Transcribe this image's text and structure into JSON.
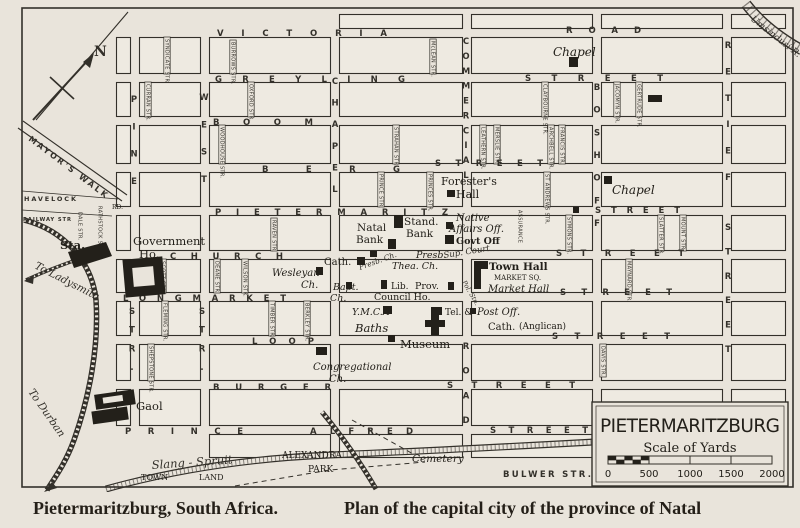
{
  "captions": {
    "left": "Pietermaritzburg, South Africa.",
    "right": "Plan of the capital city of the province of Natal"
  },
  "map": {
    "title_box": {
      "title": "PIETERMARITZBURG",
      "scale_caption": "Scale of Yards",
      "scale_ticks": [
        "0",
        "500",
        "1000",
        "1500",
        "2000"
      ]
    },
    "compass": {
      "label": "N"
    },
    "streets_h": [
      {
        "t": "VICTORIA",
        "x": 217,
        "y": 36,
        "w": 170
      },
      {
        "t": "ROAD",
        "x": 566,
        "y": 33,
        "w": 75
      },
      {
        "t": "GREYLING",
        "x": 215,
        "y": 82,
        "w": 190
      },
      {
        "t": "STREET",
        "x": 525,
        "y": 81,
        "w": 138
      },
      {
        "t": "BOOM",
        "x": 213,
        "y": 125,
        "w": 100
      },
      {
        "t": "BERG",
        "x": 262,
        "y": 172,
        "w": 138
      },
      {
        "t": "STREET",
        "x": 435,
        "y": 166,
        "w": 108
      },
      {
        "t": "PIETERMARITZ",
        "x": 215,
        "y": 215,
        "w": 233
      },
      {
        "t": "STREET",
        "x": 595,
        "y": 213,
        "w": 85
      },
      {
        "t": "CHURCH",
        "x": 170,
        "y": 259,
        "w": 113
      },
      {
        "t": "STREET",
        "x": 556,
        "y": 256,
        "w": 128
      },
      {
        "t": "LONGMARKET",
        "x": 123,
        "y": 301,
        "w": 163
      },
      {
        "t": "STREET",
        "x": 560,
        "y": 295,
        "w": 112
      },
      {
        "t": "LOOP",
        "x": 252,
        "y": 344,
        "w": 62
      },
      {
        "t": "STREET",
        "x": 552,
        "y": 339,
        "w": 118
      },
      {
        "t": "BURGER",
        "x": 213,
        "y": 390,
        "w": 118
      },
      {
        "t": "STREET",
        "x": 447,
        "y": 388,
        "w": 128
      },
      {
        "t": "PRINCE",
        "x": 125,
        "y": 434,
        "w": 118
      },
      {
        "t": "ALFRED",
        "x": 310,
        "y": 434,
        "w": 103
      },
      {
        "t": "STREET",
        "x": 490,
        "y": 433,
        "w": 98
      },
      {
        "t": "BULWER STR.",
        "x": 503,
        "y": 477,
        "w": 88
      },
      {
        "t": "HAVELOCK",
        "x": 24,
        "y": 201,
        "w": 52,
        "s": 6.5
      },
      {
        "t": "RAILWAY STR",
        "x": 23,
        "y": 221,
        "w": 48,
        "s": 5.2
      }
    ],
    "streets_v": [
      {
        "t": "PINE",
        "x": 134,
        "y1": 102,
        "y2": 184
      },
      {
        "t": "WEST",
        "x": 204,
        "y1": 100,
        "y2": 182
      },
      {
        "t": "STR.",
        "x": 132,
        "y1": 314,
        "y2": 370
      },
      {
        "t": "STR.",
        "x": 202,
        "y1": 314,
        "y2": 370
      },
      {
        "t": "CHAPEL",
        "x": 335,
        "y1": 84,
        "y2": 192
      },
      {
        "t": "COMMERCIAL",
        "x": 466,
        "y1": 44,
        "y2": 178
      },
      {
        "t": "ROAD",
        "x": 466,
        "y1": 349,
        "y2": 423
      },
      {
        "t": "BOSHOFF",
        "x": 597,
        "y1": 90,
        "y2": 226
      },
      {
        "t": "RETIEF",
        "x": 728,
        "y1": 48,
        "y2": 180
      },
      {
        "t": "STREET",
        "x": 728,
        "y1": 230,
        "y2": 352
      }
    ],
    "lanes": [
      {
        "t": "SYNDICATE STR.",
        "x": 167,
        "y1": 37,
        "y2": 74
      },
      {
        "t": "BURROWS STR.",
        "x": 233,
        "y1": 40,
        "y2": 74
      },
      {
        "t": "McLEAN STR.",
        "x": 433,
        "y1": 39,
        "y2": 74
      },
      {
        "t": "CURRAN STR.",
        "x": 148,
        "y1": 82,
        "y2": 117
      },
      {
        "t": "OXFORD STR.",
        "x": 251,
        "y1": 82,
        "y2": 117
      },
      {
        "t": "JACOMYN STR.",
        "x": 617,
        "y1": 82,
        "y2": 117
      },
      {
        "t": "GERTRUDE STR.",
        "x": 639,
        "y1": 82,
        "y2": 117
      },
      {
        "t": "CLAYBOURNE STR.",
        "x": 545,
        "y1": 82,
        "y2": 117
      },
      {
        "t": "WOODHOUSE STR.",
        "x": 222,
        "y1": 125,
        "y2": 164
      },
      {
        "t": "STRAHAN STR.",
        "x": 396,
        "y1": 125,
        "y2": 164
      },
      {
        "t": "LEATHERN STR.",
        "x": 483,
        "y1": 125,
        "y2": 164
      },
      {
        "t": "MERSLIE STR.",
        "x": 497,
        "y1": 125,
        "y2": 164
      },
      {
        "t": "ARCHBELL STR.",
        "x": 551,
        "y1": 125,
        "y2": 164
      },
      {
        "t": "FRANCIS STR.",
        "x": 562,
        "y1": 125,
        "y2": 164
      },
      {
        "t": "PRINCE STR.",
        "x": 381,
        "y1": 172,
        "y2": 207
      },
      {
        "t": "PRINCES STR.",
        "x": 430,
        "y1": 172,
        "y2": 207
      },
      {
        "t": "ST ANDREWS STR.",
        "x": 547,
        "y1": 172,
        "y2": 207
      },
      {
        "t": "ASSURANCE",
        "x": 520,
        "y1": 208,
        "y2": 251,
        "ns": true
      },
      {
        "t": "SYMONS STR.",
        "x": 569,
        "y1": 215,
        "y2": 251
      },
      {
        "t": "SLATTER STR.",
        "x": 661,
        "y1": 215,
        "y2": 251
      },
      {
        "t": "MOUNT STR.",
        "x": 683,
        "y1": 215,
        "y2": 251
      },
      {
        "t": "RAVEN STR.",
        "x": 274,
        "y1": 218,
        "y2": 251
      },
      {
        "t": "SCOTT STR.",
        "x": 163,
        "y1": 259,
        "y2": 293
      },
      {
        "t": "DEANE STR.",
        "x": 217,
        "y1": 259,
        "y2": 293
      },
      {
        "t": "WILSON STR.",
        "x": 245,
        "y1": 259,
        "y2": 293
      },
      {
        "t": "MAYNARD STR.",
        "x": 629,
        "y1": 259,
        "y2": 293
      },
      {
        "t": "TIMBER STR.",
        "x": 272,
        "y1": 301,
        "y2": 336
      },
      {
        "t": "BERKLEY STR.",
        "x": 307,
        "y1": 301,
        "y2": 336
      },
      {
        "t": "FLEMING STR.",
        "x": 165,
        "y1": 301,
        "y2": 336
      },
      {
        "t": "SHEPSTONE STR.",
        "x": 151,
        "y1": 344,
        "y2": 381
      },
      {
        "t": "DAVIS STR.",
        "x": 603,
        "y1": 344,
        "y2": 377
      },
      {
        "t": "DALE STR.",
        "x": 80,
        "y1": 210,
        "y2": 234,
        "ns": true
      },
      {
        "t": "RATHSTOCK STR.",
        "x": 100,
        "y1": 204,
        "y2": 256,
        "ns": true
      }
    ],
    "diagonals": [
      {
        "t": "MAYOR'S WALK",
        "x": 28,
        "y": 140,
        "r": 37,
        "s": 8,
        "b": true,
        "sp": 2.5
      },
      {
        "t": "To Ladysmith",
        "x": 34,
        "y": 268,
        "r": 27,
        "s": 10.5,
        "i": true
      },
      {
        "t": "To Durban",
        "x": 28,
        "y": 392,
        "r": 55,
        "s": 10.5,
        "i": true
      },
      {
        "t": "Umsindusi R.",
        "x": 750,
        "y": 20,
        "r": 38,
        "s": 9,
        "i": true
      },
      {
        "t": "Slang - Spruit",
        "x": 152,
        "y": 469,
        "r": -4,
        "s": 11.5,
        "i": true
      },
      {
        "t": "Presb. Ch.",
        "x": 360,
        "y": 270,
        "r": -20,
        "s": 7.5,
        "i": true
      },
      {
        "t": "Pol. Stn.",
        "x": 462,
        "y": 282,
        "r": 60,
        "s": 6.5,
        "i": true
      },
      {
        "t": "Sup. Court",
        "x": 444,
        "y": 258,
        "r": -9,
        "s": 8.5,
        "i": true
      }
    ],
    "pois": [
      {
        "t": "Chapel",
        "x": 553,
        "y": 56,
        "st": "i",
        "s": 12
      },
      {
        "t": "Chapel",
        "x": 612,
        "y": 194,
        "st": "i",
        "s": 12
      },
      {
        "t": "Forester's",
        "x": 441,
        "y": 185,
        "st": "p",
        "s": 11
      },
      {
        "t": "Hall",
        "x": 456,
        "y": 198,
        "st": "p",
        "s": 11
      },
      {
        "t": "Native",
        "x": 456,
        "y": 221,
        "st": "i",
        "s": 10
      },
      {
        "t": "Affairs Off.",
        "x": 449,
        "y": 232,
        "st": "i",
        "s": 10
      },
      {
        "t": "Govt Off",
        "x": 456,
        "y": 244,
        "st": "b",
        "s": 9.5
      },
      {
        "t": "Town Hall",
        "x": 489,
        "y": 270,
        "st": "b",
        "s": 10.5
      },
      {
        "t": "MARKET SQ.",
        "x": 494,
        "y": 280,
        "st": "p",
        "s": 7
      },
      {
        "t": "Market Hall",
        "x": 488,
        "y": 292,
        "st": "i",
        "s": 10
      },
      {
        "t": "Natal",
        "x": 357,
        "y": 231,
        "st": "p",
        "s": 10.5
      },
      {
        "t": "Bank",
        "x": 356,
        "y": 243,
        "st": "p",
        "s": 10.5
      },
      {
        "t": "Stand.",
        "x": 404,
        "y": 225,
        "st": "p",
        "s": 10.5
      },
      {
        "t": "Bank",
        "x": 406,
        "y": 237,
        "st": "p",
        "s": 10.5
      },
      {
        "t": "Cath.",
        "x": 324,
        "y": 265,
        "st": "p",
        "s": 10
      },
      {
        "t": "Presb.",
        "x": 416,
        "y": 258,
        "st": "i",
        "s": 9.5
      },
      {
        "t": "Thea. Ch.",
        "x": 392,
        "y": 269,
        "st": "i",
        "s": 9.5
      },
      {
        "t": "Wesleyan",
        "x": 272,
        "y": 276,
        "st": "i",
        "s": 10
      },
      {
        "t": "Ch.",
        "x": 301,
        "y": 288,
        "st": "i",
        "s": 10
      },
      {
        "t": "Bapt.",
        "x": 333,
        "y": 290,
        "st": "i",
        "s": 9.5
      },
      {
        "t": "Ch.",
        "x": 330,
        "y": 301,
        "st": "i",
        "s": 9.5
      },
      {
        "t": "Lib.",
        "x": 391,
        "y": 289,
        "st": "p",
        "s": 9
      },
      {
        "t": "Prov.",
        "x": 415,
        "y": 289,
        "st": "p",
        "s": 9.5
      },
      {
        "t": "Council Ho.",
        "x": 374,
        "y": 300,
        "st": "p",
        "s": 9.5
      },
      {
        "t": "Y.M.C.A",
        "x": 352,
        "y": 315,
        "st": "i",
        "s": 9.5
      },
      {
        "t": "Baths",
        "x": 355,
        "y": 332,
        "st": "i",
        "s": 11.5
      },
      {
        "t": "Tel. &",
        "x": 445,
        "y": 315,
        "st": "p",
        "s": 9
      },
      {
        "t": "Post Off.",
        "x": 477,
        "y": 315,
        "st": "i",
        "s": 10
      },
      {
        "t": "Cath.",
        "x": 488,
        "y": 330,
        "st": "p",
        "s": 10
      },
      {
        "t": "(Anglican)",
        "x": 519,
        "y": 329,
        "st": "p",
        "s": 9
      },
      {
        "t": "Museum",
        "x": 400,
        "y": 348,
        "st": "p",
        "s": 11.5
      },
      {
        "t": "Congregational",
        "x": 313,
        "y": 370,
        "st": "i",
        "s": 10
      },
      {
        "t": "Ch.",
        "x": 329,
        "y": 382,
        "st": "i",
        "s": 10
      },
      {
        "t": "Government",
        "x": 133,
        "y": 245,
        "st": "p",
        "s": 11.5
      },
      {
        "t": "Ho.",
        "x": 139,
        "y": 258,
        "st": "p",
        "s": 11.5
      },
      {
        "t": "Sta.",
        "x": 60,
        "y": 249,
        "st": "b",
        "s": 11.5
      },
      {
        "t": "Gaol",
        "x": 136,
        "y": 410,
        "st": "p",
        "s": 11.5
      },
      {
        "t": "ALEXANDRA",
        "x": 282,
        "y": 458,
        "st": "p",
        "s": 9
      },
      {
        "t": "PARK",
        "x": 308,
        "y": 472,
        "st": "p",
        "s": 9
      },
      {
        "t": "Cemetery",
        "x": 412,
        "y": 462,
        "st": "i",
        "s": 10.5
      },
      {
        "t": "TOWN",
        "x": 141,
        "y": 480,
        "st": "p",
        "s": 8
      },
      {
        "t": "LAND",
        "x": 199,
        "y": 480,
        "st": "p",
        "s": 8
      },
      {
        "t": "RD.",
        "x": 112,
        "y": 209,
        "st": "p",
        "s": 6
      }
    ],
    "buildings": [
      {
        "k": "rect",
        "x": 569,
        "y": 57,
        "w": 9,
        "h": 10
      },
      {
        "k": "rect",
        "x": 604,
        "y": 176,
        "w": 8,
        "h": 8
      },
      {
        "k": "rect",
        "x": 447,
        "y": 190,
        "w": 8,
        "h": 7
      },
      {
        "k": "rect",
        "x": 446,
        "y": 222,
        "w": 7,
        "h": 7
      },
      {
        "k": "rect",
        "x": 445,
        "y": 235,
        "w": 9,
        "h": 9
      },
      {
        "k": "rect",
        "x": 394,
        "y": 215,
        "w": 9,
        "h": 13
      },
      {
        "k": "rect",
        "x": 388,
        "y": 239,
        "w": 8,
        "h": 10
      },
      {
        "k": "rect",
        "x": 370,
        "y": 251,
        "w": 7,
        "h": 6
      },
      {
        "k": "rect",
        "x": 357,
        "y": 257,
        "w": 8,
        "h": 8
      },
      {
        "k": "rect",
        "x": 316,
        "y": 267,
        "w": 7,
        "h": 8
      },
      {
        "k": "rect",
        "x": 346,
        "y": 282,
        "w": 6,
        "h": 7
      },
      {
        "k": "rect",
        "x": 381,
        "y": 280,
        "w": 6,
        "h": 9
      },
      {
        "k": "rect",
        "x": 448,
        "y": 282,
        "w": 6,
        "h": 8
      },
      {
        "k": "rect",
        "x": 383,
        "y": 306,
        "w": 9,
        "h": 8
      },
      {
        "k": "rect",
        "x": 431,
        "y": 307,
        "w": 11,
        "h": 8
      },
      {
        "k": "rect",
        "x": 470,
        "y": 308,
        "w": 6,
        "h": 6
      },
      {
        "k": "rect",
        "x": 388,
        "y": 335,
        "w": 7,
        "h": 7
      },
      {
        "k": "rect",
        "x": 316,
        "y": 347,
        "w": 11,
        "h": 8
      },
      {
        "k": "rect",
        "x": 573,
        "y": 207,
        "w": 6,
        "h": 6
      },
      {
        "k": "rect",
        "x": 648,
        "y": 95,
        "w": 14,
        "h": 7
      },
      {
        "k": "poly",
        "p": "68,252 106,242 112,256 74,268"
      },
      {
        "k": "poly",
        "p": "474,261 488,261 488,269 481,269 481,289 474,289"
      },
      {
        "k": "poly",
        "p": "431,314 439,314 439,320 445,320 445,327 439,327 439,335 431,335 431,327 425,327 425,320 431,320"
      },
      {
        "k": "govhouse"
      },
      {
        "k": "gaol"
      }
    ]
  }
}
